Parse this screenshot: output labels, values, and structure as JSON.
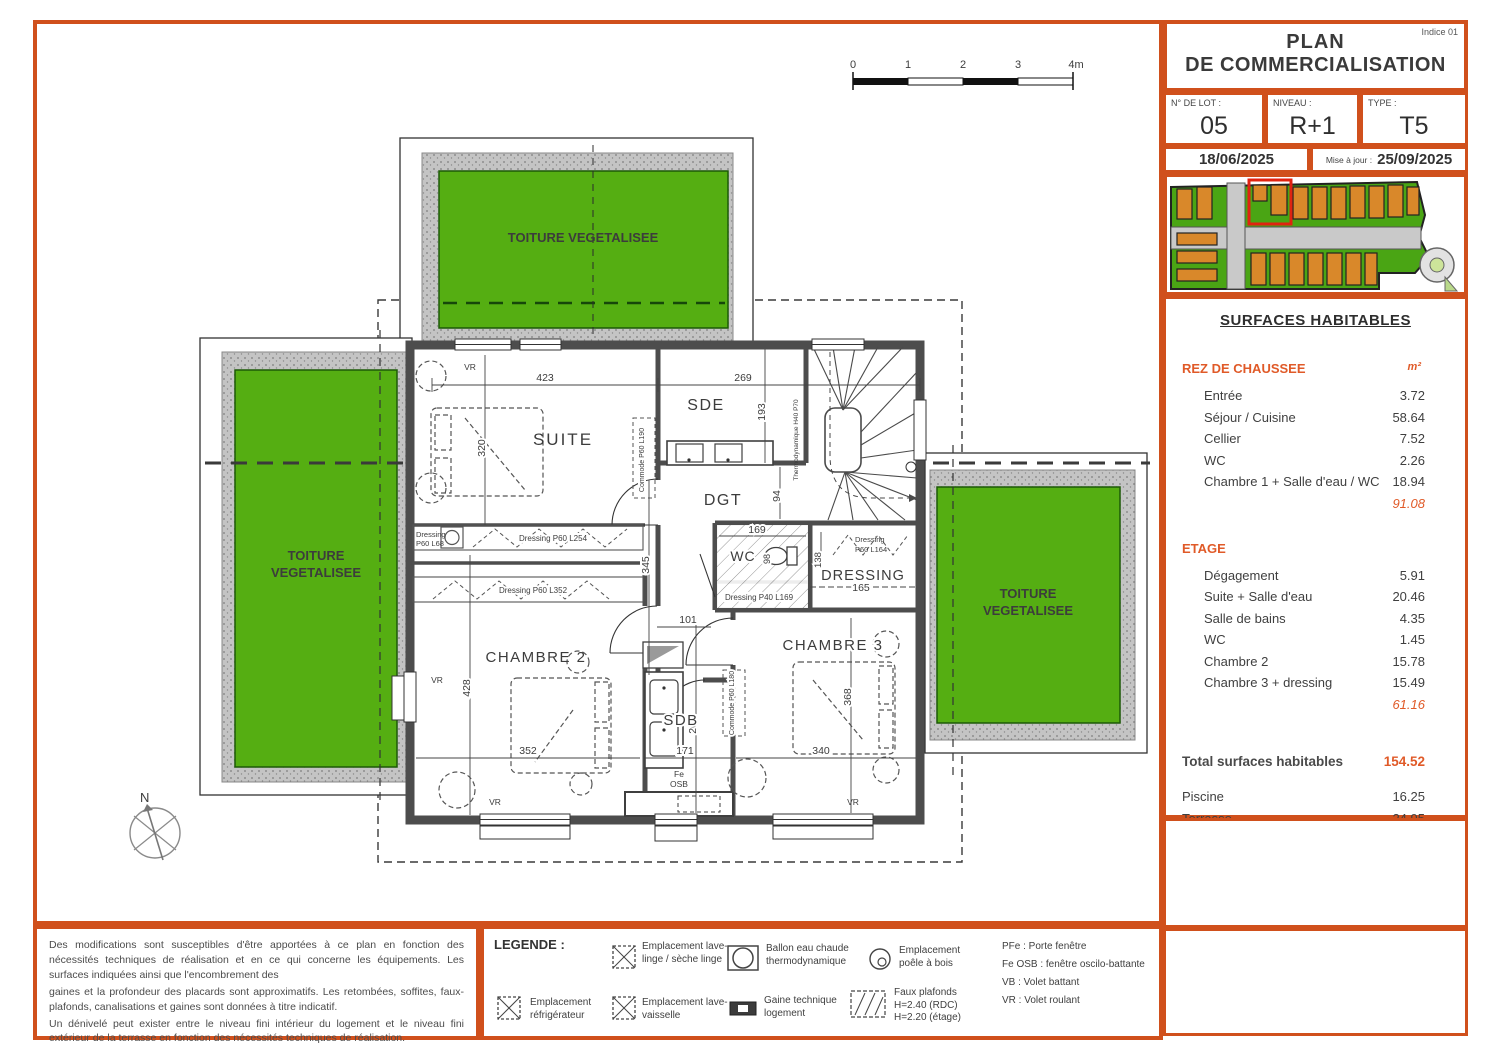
{
  "colors": {
    "orange": "#d0501c",
    "orange_text": "#e05a28",
    "green_roof": "#55ae12",
    "green_dark": "#1c5a06",
    "wall_gray": "#4d4d4d",
    "site_green": "#4aa514",
    "site_orange": "#d9882a",
    "highlight_red": "#e02310"
  },
  "title_block": {
    "indice": "Indice 01",
    "line1": "PLAN",
    "line2": "DE COMMERCIALISATION",
    "lot_label": "N° DE LOT :",
    "lot_value": "05",
    "niveau_label": "NIVEAU :",
    "niveau_value": "R+1",
    "type_label": "TYPE :",
    "type_value": "T5",
    "date": "18/06/2025",
    "maj_label": "Mise à jour :",
    "maj_date": "25/09/2025"
  },
  "surfaces": {
    "title": "SURFACES HABITABLES",
    "unit": "m²",
    "rdc": {
      "label": "REZ DE CHAUSSEE",
      "rows": [
        {
          "label": "Entrée",
          "value": "3.72"
        },
        {
          "label": "Séjour / Cuisine",
          "value": "58.64"
        },
        {
          "label": "Cellier",
          "value": "7.52"
        },
        {
          "label": "WC",
          "value": "2.26"
        },
        {
          "label": "Chambre 1 + Salle d'eau / WC",
          "value": "18.94"
        }
      ],
      "total": "91.08"
    },
    "etage": {
      "label": "ETAGE",
      "rows": [
        {
          "label": "Dégagement",
          "value": "5.91"
        },
        {
          "label": "Suite + Salle d'eau",
          "value": "20.46"
        },
        {
          "label": "Salle de bains",
          "value": "4.35"
        },
        {
          "label": "WC",
          "value": "1.45"
        },
        {
          "label": "Chambre 2",
          "value": "15.78"
        },
        {
          "label": "Chambre 3 + dressing",
          "value": "15.49"
        }
      ],
      "total": "61.16"
    },
    "total_label": "Total surfaces habitables",
    "total_value": "154.52",
    "annexes": [
      {
        "label": "Piscine",
        "value": "16.25"
      },
      {
        "label": "Terrasse",
        "value": "24.95"
      },
      {
        "label": "Jardin",
        "value": "167.00"
      },
      {
        "label": "Garage",
        "value": "19.97"
      }
    ]
  },
  "plan": {
    "north": "N",
    "toiture": "TOITURE VEGETALISEE",
    "scale_ticks": [
      "0",
      "1",
      "2",
      "3",
      "4m"
    ],
    "rooms": {
      "suite": "SUITE",
      "sde": "SDE",
      "dgt": "DGT",
      "wc": "WC",
      "dressing": "DRESSING",
      "chambre2": "CHAMBRE 2",
      "sdb": "SDB",
      "chambre3": "CHAMBRE 3"
    },
    "dims": {
      "suite_top": "423",
      "right_top": "269",
      "suite_left": "320",
      "sde_side": "193",
      "dgt_side": "94",
      "hall_len": "345",
      "hall_w": "101",
      "wc_w": "169",
      "wc_side": "98",
      "dress_w": "165",
      "dress_side": "138",
      "ch2_left": "428",
      "ch2_w": "352",
      "sdb_w": "171",
      "ch3_w": "340",
      "ch3_side": "368",
      "sdb_side": "262"
    },
    "annotations": {
      "vr": "VR",
      "fe": "Fe",
      "osb": "OSB",
      "dressing_a": "Dressing",
      "dressing_a2": "P60 L68",
      "dressing_b": "Dressing P60 L254",
      "dressing_c": "Dressing P60 L352",
      "dressing_d": "Dressing P40 L169",
      "dressing_e": "Dressing",
      "dressing_e2": "P60 L164",
      "commode_a": "Commode P60 L190",
      "commode_b": "Commode P60 L180",
      "thermo": "Thermodynamique H40 P70"
    }
  },
  "legend": {
    "title": "LEGENDE :",
    "items": [
      {
        "label": "Emplacement lave-linge / sèche linge"
      },
      {
        "label": "Ballon eau chaude thermodynamique"
      },
      {
        "label": "Emplacement poêle à bois"
      },
      {
        "label": "Emplacement réfrigérateur"
      },
      {
        "label": "Emplacement lave-vaisselle"
      },
      {
        "label": "Gaine technique logement"
      },
      {
        "label": "Faux plafonds H=2.40 (RDC) H=2.20 (étage)"
      }
    ],
    "abbreviations": [
      "PFe : Porte fenêtre",
      "Fe OSB : fenêtre oscilo-battante",
      "VB : Volet battant",
      "VR : Volet roulant"
    ]
  },
  "disclaimer": {
    "p1": "Des modifications sont susceptibles d'être apportées à ce plan en fonction des nécessités techniques de réalisation et en ce qui concerne les équipements. Les surfaces indiquées ainsi que l'encombrement des",
    "p2": "gaines et la profondeur des placards sont approximatifs. Les retombées, soffites, faux-plafonds, canalisations et gaines sont données à titre indicatif.",
    "p3": "Un dénivelé peut exister entre le niveau fini intérieur du logement et le niveau fini extérieur de la terrasse en fonction des nécessités techniques de réalisation."
  }
}
